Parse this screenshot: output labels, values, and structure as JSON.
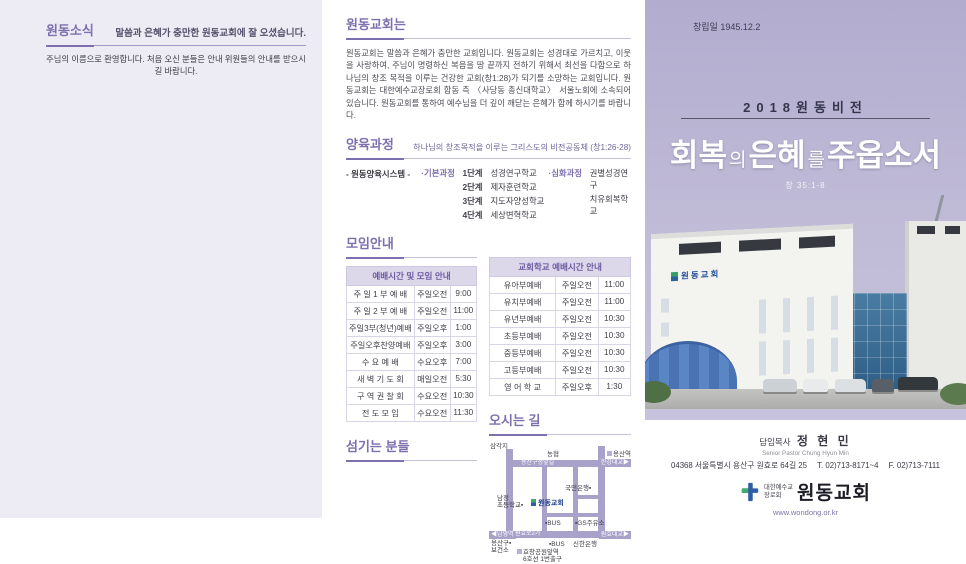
{
  "colors": {
    "accent": "#7e6fae",
    "table_header_bg": "#ddd7ea",
    "sky": "#b2accf",
    "road": "#a8a1c9"
  },
  "left_panel": {
    "title": "원동소식",
    "headline": "말씀과 은혜가 충만한 원동교회에 잘 오셨습니다.",
    "welcome": "주님의 이름으로 환영합니다. 처음 오신 분들은 안내 위원들의 안내를 받으시길 바랍니다."
  },
  "about": {
    "title": "원동교회는",
    "body": "원동교회는 말씀과 은혜가 충만한 교회입니다. 원동교회는 성경대로 가르치고, 이웃을 사랑하여, 주님이 명령하신 복음을 땅 끝까지 전하기 위해서 최선을 다함으로 하나님의 창조 목적을 이루는 건강한 교회(창1:28)가 되기를 소망하는 교회입니다. 원동교회는 대한예수교장로회 합동 측 〈사당동 총신대학교〉 서울노회에 소속되어 있습니다. 원동교회를 통하여 예수님을 더 깊이 깨닫는 은혜가 함께 하시기를 바랍니다."
  },
  "nurture": {
    "title": "양육과정",
    "subtitle": "하나님의 창조목적을 이루는 그리스도의 비전공동체 (창1:26-28)",
    "system_label": "- 원동양육시스템 -",
    "basic_label": "·기본과정",
    "basic_steps": [
      {
        "step": "1단계",
        "name": "성경연구학교"
      },
      {
        "step": "2단계",
        "name": "제자훈련학교"
      },
      {
        "step": "3단계",
        "name": "지도자양성학교"
      },
      {
        "step": "4단계",
        "name": "세상변혁학교"
      }
    ],
    "advanced_label": "·심화과정",
    "advanced_items": [
      "권별성경연구",
      "치유회복학교"
    ]
  },
  "meetings": {
    "title": "모임안내",
    "worship": {
      "header": "예배시간 및 모임 안내",
      "rows": [
        [
          "주 일 1 부 예 배",
          "주일오전",
          "9:00"
        ],
        [
          "주 일 2 부 예 배",
          "주일오전",
          "11:00"
        ],
        [
          "주일3부(청년)예배",
          "주일오후",
          "1:00"
        ],
        [
          "주일오후찬양예배",
          "주일오후",
          "3:00"
        ],
        [
          "수 요 예 배",
          "수요오후",
          "7:00"
        ],
        [
          "새 벽 기 도 회",
          "매일오전",
          "5:30"
        ],
        [
          "구 역 권 찰 회",
          "수요오전",
          "10:30"
        ],
        [
          "전 도 모 임",
          "수요오전",
          "11:30"
        ]
      ]
    },
    "school": {
      "header": "교회학교 예배시간 안내",
      "rows": [
        [
          "유아부예배",
          "주일오전",
          "11:00"
        ],
        [
          "유치부예배",
          "주일오전",
          "11:00"
        ],
        [
          "유년부예배",
          "주일오전",
          "10:30"
        ],
        [
          "초등부예배",
          "주일오전",
          "10:30"
        ],
        [
          "중등부예배",
          "주일오전",
          "10:30"
        ],
        [
          "고등부예배",
          "주일오전",
          "10:30"
        ],
        [
          "영 어 학 교",
          "주일오후",
          "1:30"
        ]
      ]
    }
  },
  "servants": {
    "title": "섬기는 분들"
  },
  "directions": {
    "title": "오시는 길",
    "map": {
      "samgakji": "삼각지",
      "nonghyup": "농협",
      "yongsan_station": "용산역",
      "top_road": "용산구청앞길",
      "bridge_top": "한강대교▶",
      "kb_bank": "국민은행▪",
      "school": "남정\n초등학교▪",
      "church": "원동교회",
      "bus_upper": "▪BUS",
      "gas_station": "▪GS주유소",
      "namyeong": "◀남영역",
      "bottom_road": "원효로2가",
      "bus_lower": "▪BUS",
      "shinhan_bank": "신한은행",
      "bridge_bottom": "원효대교▶",
      "health_center": "용산구▪\n보건소",
      "subway": "효창공원앞역\n6호선 1번출구"
    }
  },
  "cover": {
    "founded": "창립일 1945.12.2",
    "vision": "2018원동비전",
    "title": {
      "r1": "회복",
      "j1": "의",
      "r2": "은혜",
      "j2": "를",
      "r3": "주옵소서"
    },
    "verse": "창 35:1-8",
    "building_sign": "원동교회",
    "footer": {
      "pastor_label": "담임목사",
      "pastor_name": "정 현 민",
      "pastor_en": "Senior Pastor  Chung Hyun Min",
      "address": "04368 서울특별시 용산구 원효로 64길 25",
      "tel": "T. 02)713-8171~4",
      "fax": "F. 02)713-7111",
      "denomination": "대한예수교\n장로회",
      "church_name": "원동교회",
      "website": "www.wondong.or.kr"
    }
  }
}
